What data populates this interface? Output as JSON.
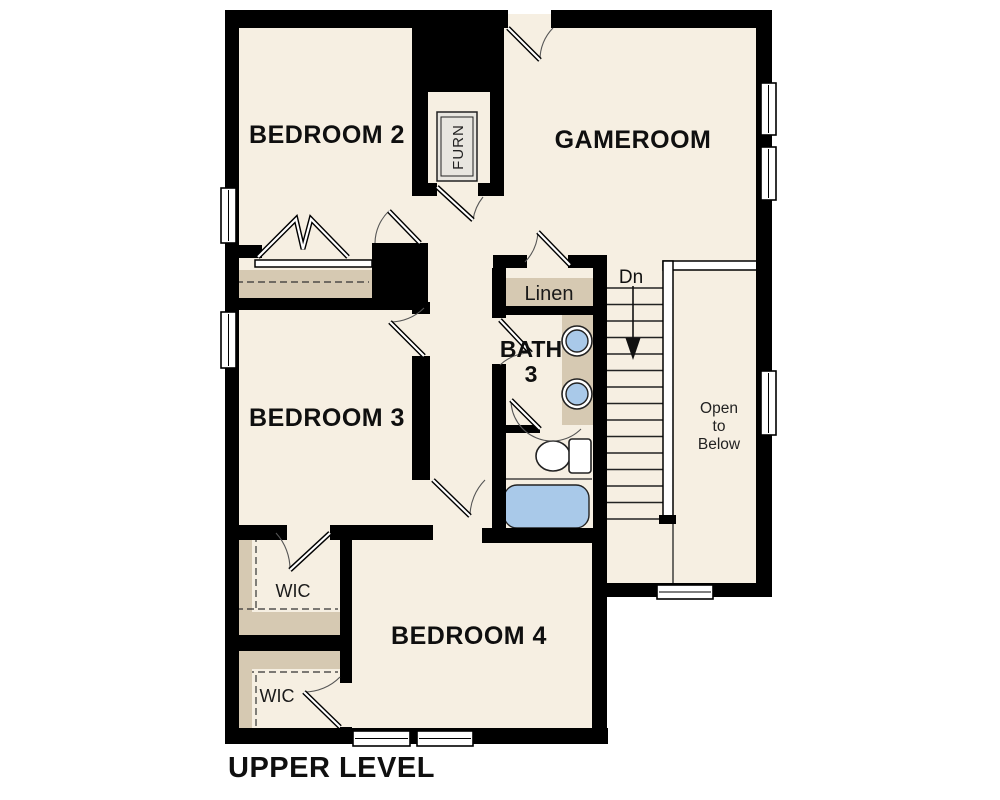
{
  "floorplan": {
    "level_title": "UPPER LEVEL",
    "rooms": {
      "bedroom2": "BEDROOM 2",
      "gameroom": "GAMEROOM",
      "bedroom3": "BEDROOM 3",
      "bedroom4": "BEDROOM 4",
      "bath3_line1": "BATH",
      "bath3_line2": "3",
      "linen": "Linen",
      "wic_upper": "WIC",
      "wic_lower": "WIC",
      "furnace": "FURN",
      "stairs_direction": "Dn",
      "open_to_below_line1": "Open",
      "open_to_below_line2": "to",
      "open_to_below_line3": "Below"
    },
    "colors": {
      "background": "#ffffff",
      "floor": "#f6efe2",
      "wall": "#000000",
      "shelf_tan": "#d6c9b2",
      "fixture_blue": "#a9c9e9",
      "furnace_grey": "#e8e6e0"
    }
  }
}
